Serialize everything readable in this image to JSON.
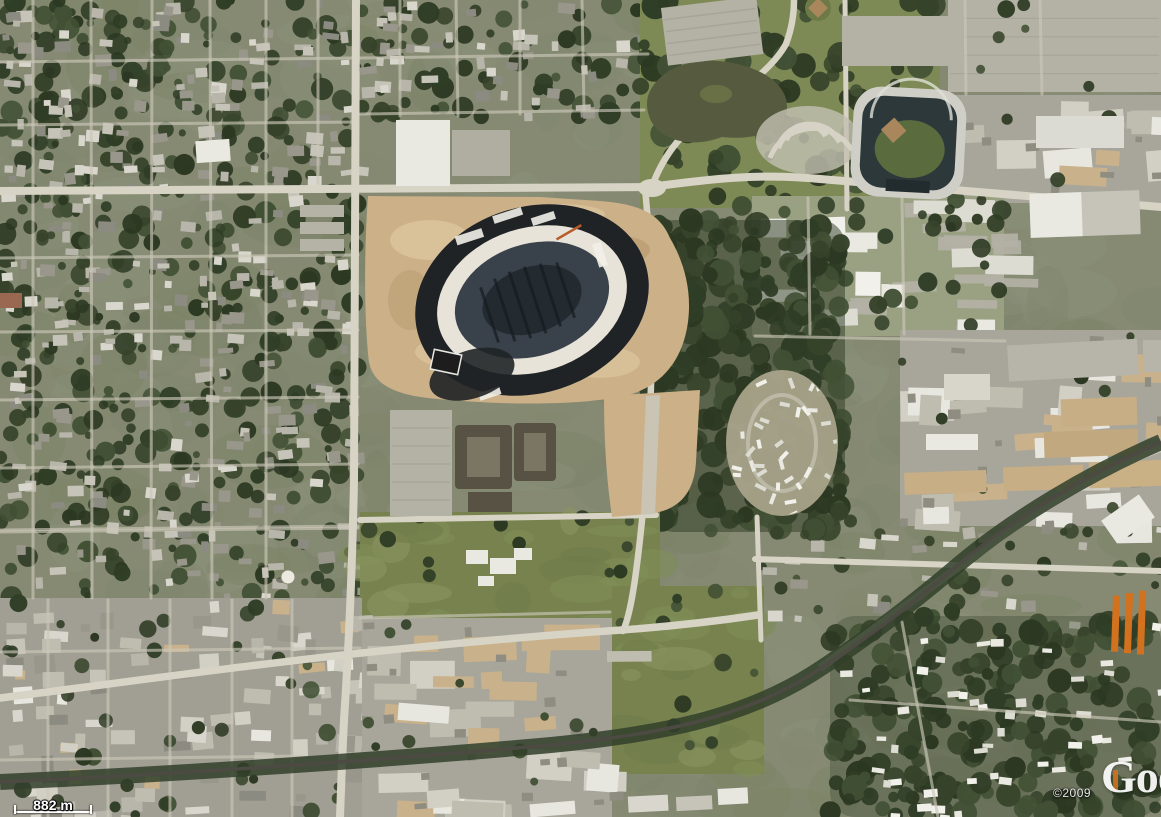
{
  "overlay": {
    "scale_label": "882 m",
    "copyright": "©2009",
    "logo_text": "Google"
  },
  "palette": {
    "base": "#868a73",
    "road": "#d7d3c5",
    "roadMinor": "#cbc7b8",
    "dirt": "#ccb088",
    "dirtLight": "#dec9a3",
    "dirtDark": "#b4986d",
    "treeDark": "#2e3a24",
    "grass": "#77824e",
    "grassLight": "#828d58",
    "parking": "#b4b1a5",
    "white": "#e9e8e1",
    "grayBuild": "#c6c3b8",
    "tanRoof": "#c7ae85",
    "rail": "#4c4a42",
    "railTrees": "#31402a",
    "water": "#565b40",
    "waterLight": "#6a7046",
    "stadiumDark": "#1f2326",
    "stadiumWhite": "#e7e3d8",
    "stadiumBowl": "#39424a",
    "stadiumField": "#232a30",
    "ballRim": "#cfcfc7",
    "ballStands": "#2d383b",
    "ballField": "#5a6c3e",
    "infield": "#a9865c",
    "orange": "#d2721f",
    "campusBase": "#9aa183",
    "indBase": "#a8a69a",
    "indBase2": "#a19f93",
    "parkBase": "#7e8a55",
    "apartment": "#575243",
    "apartmentLight": "#7b7563",
    "mhpBase": "#a8a38a"
  },
  "texture_colors": {
    "mottle": [
      "#7f836d",
      "#8d917a",
      "#83886e",
      "#798062"
    ],
    "trees": [
      "#2c3822",
      "#36432a",
      "#415034",
      "#2f3d26"
    ],
    "roofs": [
      "#b8b5aa",
      "#99978c",
      "#d9d7cd",
      "#8c8b81",
      "#c6c3b8"
    ],
    "industrial": [
      "#e7e6df",
      "#d2d0c5",
      "#bfbcb0",
      "#c9b28b"
    ],
    "grass": [
      "#818d57",
      "#6f7b49",
      "#8a9560"
    ],
    "white_roofs": [
      "#e9e8e1",
      "#dddcd2",
      "#f1f0ea"
    ]
  },
  "texture_regions": [
    {
      "name": "base-mottle",
      "type": "mottle",
      "x": 0,
      "y": 0,
      "w": 1161,
      "h": 817,
      "seed": 9,
      "d": 1
    },
    {
      "name": "nw-residential",
      "type": "urban",
      "x": 0,
      "y": 0,
      "w": 358,
      "h": 192,
      "seed": 11,
      "d": 1.2
    },
    {
      "name": "w-residential",
      "type": "urban",
      "x": 0,
      "y": 192,
      "w": 358,
      "h": 406,
      "seed": 12,
      "d": 1.0
    },
    {
      "name": "n-residential",
      "type": "urban",
      "x": 360,
      "y": 0,
      "w": 286,
      "h": 118,
      "seed": 13,
      "d": 1.0
    },
    {
      "name": "n-park",
      "type": "park",
      "x": 640,
      "y": 0,
      "w": 300,
      "h": 208,
      "seed": 14,
      "d": 1.0
    },
    {
      "name": "ne-parking",
      "type": "parking",
      "x": 948,
      "y": 0,
      "w": 213,
      "h": 92,
      "seed": 15,
      "d": 1.0
    },
    {
      "name": "ne-industrial",
      "type": "industrial",
      "x": 935,
      "y": 95,
      "w": 226,
      "h": 108,
      "seed": 16,
      "d": 0.8
    },
    {
      "name": "e-office-park",
      "type": "campus",
      "x": 752,
      "y": 196,
      "w": 252,
      "h": 140,
      "seed": 17,
      "d": 1.0
    },
    {
      "name": "mid-woods",
      "type": "trees",
      "x": 650,
      "y": 220,
      "w": 195,
      "h": 312,
      "seed": 18,
      "d": 1.1
    },
    {
      "name": "e-industrial",
      "type": "industrial",
      "x": 900,
      "y": 330,
      "w": 261,
      "h": 196,
      "seed": 19,
      "d": 0.9
    },
    {
      "name": "mid-fields",
      "type": "grass",
      "x": 360,
      "y": 512,
      "w": 300,
      "h": 112,
      "seed": 20,
      "d": 1.0
    },
    {
      "name": "s-field",
      "type": "grass",
      "x": 612,
      "y": 586,
      "w": 152,
      "h": 188,
      "seed": 21,
      "d": 1.0
    },
    {
      "name": "se-strip",
      "type": "urban-sparse",
      "x": 762,
      "y": 520,
      "w": 399,
      "h": 108,
      "seed": 22,
      "d": 0.7
    },
    {
      "name": "sw-industrial",
      "type": "industrial-small",
      "x": 0,
      "y": 598,
      "w": 362,
      "h": 219,
      "seed": 23,
      "d": 1.2
    },
    {
      "name": "s-industrial",
      "type": "industrial",
      "x": 362,
      "y": 618,
      "w": 250,
      "h": 199,
      "seed": 24,
      "d": 1.1
    },
    {
      "name": "se-woods",
      "type": "trees-residential",
      "x": 830,
      "y": 616,
      "w": 331,
      "h": 201,
      "seed": 25,
      "d": 1.0
    },
    {
      "name": "mobile-home-park",
      "type": "mhp",
      "x": 728,
      "y": 372,
      "w": 110,
      "h": 142,
      "seed": 26,
      "d": 1.0
    }
  ],
  "street_segments": [
    [
      33,
      0,
      33,
      598
    ],
    [
      91,
      0,
      92,
      598
    ],
    [
      152,
      0,
      151,
      598
    ],
    [
      210,
      0,
      212,
      598
    ],
    [
      266,
      0,
      266,
      598
    ],
    [
      318,
      0,
      318,
      188
    ],
    [
      0,
      62,
      358,
      58
    ],
    [
      0,
      125,
      358,
      122
    ],
    [
      0,
      258,
      358,
      255
    ],
    [
      0,
      332,
      358,
      330
    ],
    [
      0,
      400,
      358,
      397
    ],
    [
      0,
      468,
      358,
      464
    ],
    [
      0,
      532,
      358,
      528
    ],
    [
      400,
      0,
      400,
      116
    ],
    [
      456,
      0,
      458,
      116
    ],
    [
      520,
      0,
      520,
      114
    ],
    [
      582,
      0,
      584,
      110
    ],
    [
      360,
      58,
      648,
      54
    ],
    [
      360,
      114,
      644,
      110
    ],
    [
      48,
      600,
      48,
      817
    ],
    [
      108,
      600,
      108,
      817
    ],
    [
      170,
      600,
      170,
      817
    ],
    [
      232,
      600,
      232,
      817
    ],
    [
      292,
      600,
      292,
      817
    ],
    [
      0,
      652,
      360,
      648
    ],
    [
      0,
      760,
      300,
      756
    ],
    [
      755,
      336,
      1005,
      341
    ],
    [
      965,
      0,
      966,
      94
    ],
    [
      1040,
      0,
      1042,
      94
    ],
    [
      360,
      618,
      610,
      612
    ],
    [
      0,
      530,
      358,
      526
    ],
    [
      808,
      198,
      810,
      334
    ],
    [
      902,
      198,
      904,
      334
    ],
    [
      850,
      700,
      1161,
      722
    ],
    [
      902,
      622,
      938,
      817
    ]
  ]
}
